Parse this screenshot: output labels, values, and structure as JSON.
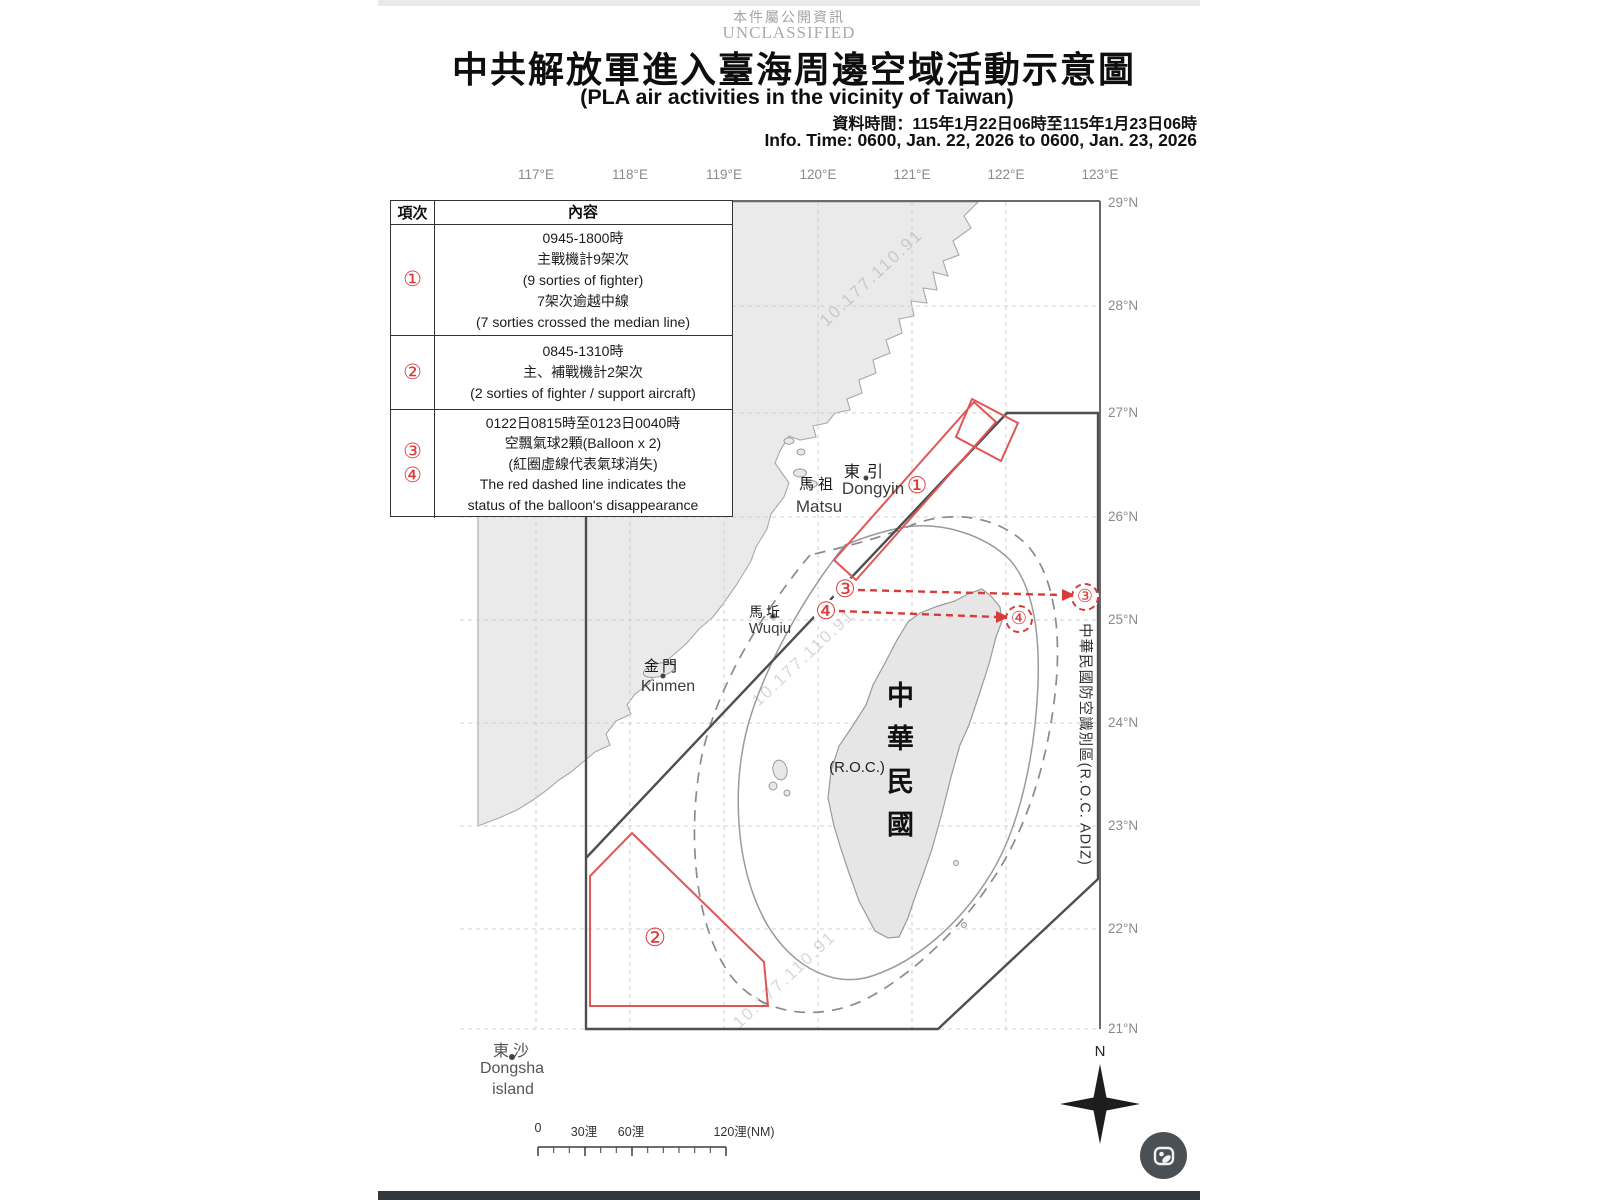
{
  "header": {
    "classification_cjk": "本件屬公開資訊",
    "classification_en": "UNCLASSIFIED",
    "title_cjk": "中共解放軍進入臺海周邊空域活動示意圖",
    "title_en": "(PLA air activities in the vicinity of Taiwan)",
    "info_time_cjk": "資料時間：115年1月22日06時至115年1月23日06時",
    "info_time_en": "Info. Time: 0600, Jan. 22, 2026 to 0600, Jan. 23, 2026"
  },
  "legend_table": {
    "col_headers": [
      "項次",
      "內容"
    ],
    "rows": [
      {
        "num": "①",
        "lines": [
          "0945-1800時",
          "主戰機計9架次",
          "(9 sorties of fighter)",
          "7架次逾越中線",
          "(7 sorties crossed the median line)"
        ]
      },
      {
        "num": "②",
        "lines": [
          "0845-1310時",
          "主、補戰機計2架次",
          "(2 sorties of fighter / support aircraft)"
        ]
      },
      {
        "num": "③",
        "num2": "④",
        "lines": [
          "0122日0815時至0123日0040時",
          "空飄氣球2顆(Balloon x 2)",
          "(紅圈虛線代表氣球消失)",
          "The red dashed line indicates the",
          "status of the balloon's disappearance"
        ]
      }
    ]
  },
  "axes": {
    "lon_labels": [
      "117°E",
      "118°E",
      "119°E",
      "120°E",
      "121°E",
      "122°E",
      "123°E"
    ],
    "lat_labels": [
      "29°N",
      "28°N",
      "27°N",
      "26°N",
      "25°N",
      "24°N",
      "23°N",
      "22°N",
      "21°N"
    ]
  },
  "map": {
    "places": {
      "dongyin_cjk": "東引",
      "dongyin_en": "Dongyin",
      "matsu_cjk": "馬祖",
      "matsu_en": "Matsu",
      "wuqiu_cjk": "馬坵",
      "wuqiu_en": "Wuqiu",
      "kinmen_cjk": "金門",
      "kinmen_en": "Kinmen",
      "dongsha_cjk": "東沙",
      "dongsha_en_1": "Dongsha",
      "dongsha_en_2": "island",
      "taiwan_cjk": "中華民國",
      "taiwan_en": "(R.O.C.)"
    },
    "adiz_label": "中華民國防空識別區(R.O.C. ADIZ)",
    "markers": {
      "m1": "①",
      "m2": "②",
      "m3": "③",
      "m4": "④"
    },
    "compass_n": "N",
    "watermark": "10.177.110.91"
  },
  "scale_bar": {
    "labels": [
      "0",
      "30浬",
      "60浬",
      "120浬(NM)"
    ]
  },
  "colors": {
    "red": "#d93a3a",
    "boundary": "#4e4e4e",
    "land": "#eaeaea",
    "grid": "#cfcfcf"
  }
}
